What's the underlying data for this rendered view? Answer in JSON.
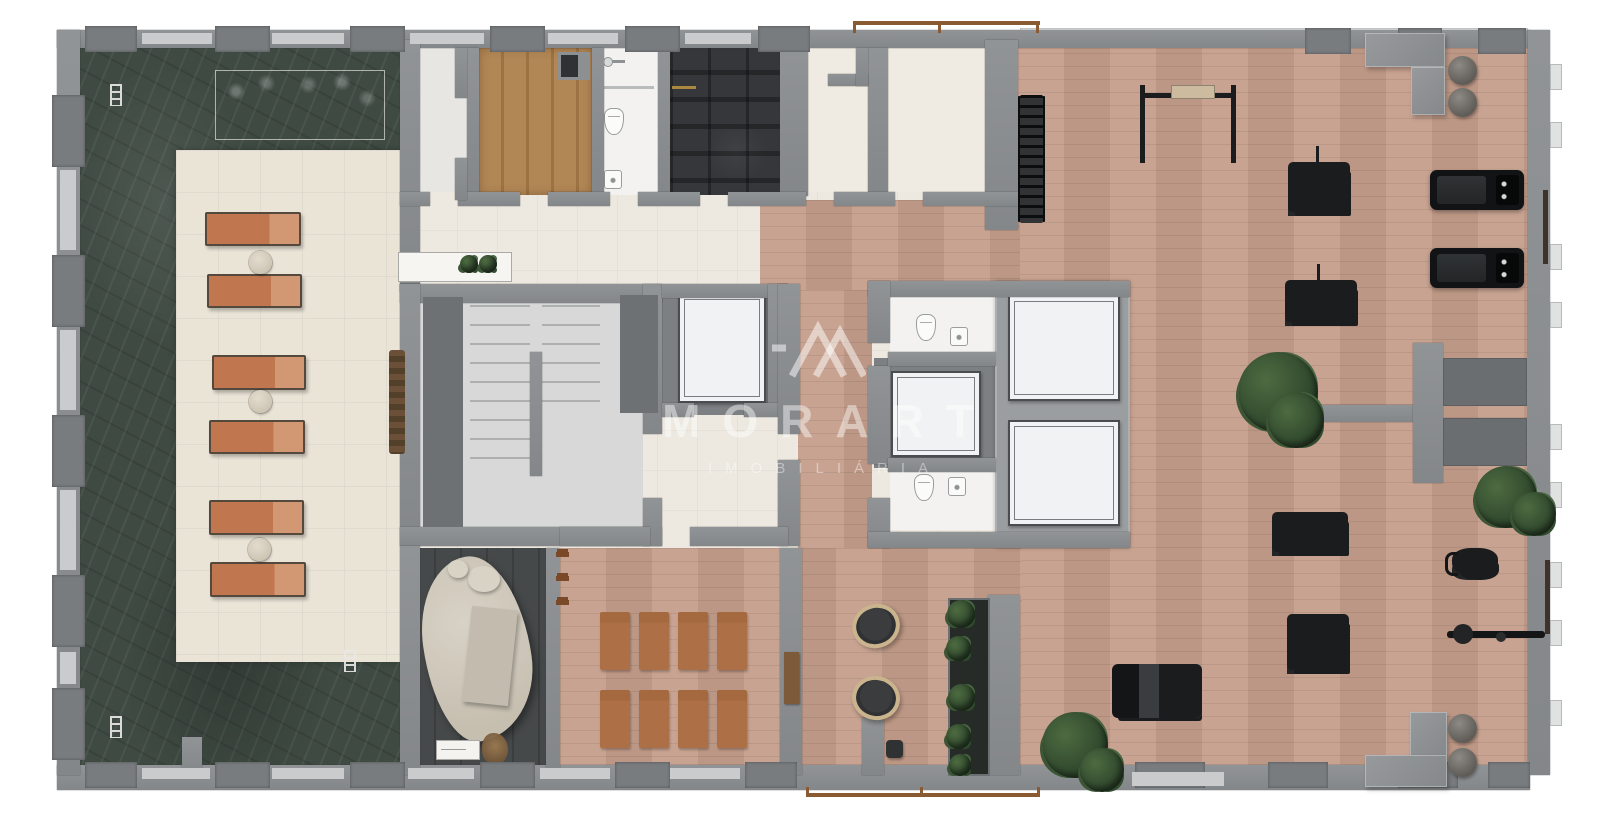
{
  "watermark": {
    "title": "MORART",
    "subtitle": "IMOBILIÁRIA"
  },
  "palette": {
    "pool": "#3e4a42",
    "deck": "#eae4d7",
    "plate": "#ede9e0",
    "wall": "#8a8d8f",
    "wall-dark": "#797c7e",
    "wall-light": "#c9cbcc",
    "wood": "#c59e8b",
    "sauna": "#ad8352",
    "dark-room": "#35373a",
    "slate": "#46494a",
    "slab": "#9b9ea0",
    "lounger": "#c88159",
    "mat": "#ad6f46",
    "equip": "#1b1c1d",
    "rail": "#8a5a33",
    "brass": "#a98940",
    "elev": "#f1f2f3",
    "tile": "#f3f2f0",
    "panel": "#6e7173",
    "green": "#3a5531",
    "cream-tile": "#efebe2",
    "stair-floor": "#d7d8d7"
  },
  "plan": {
    "walls": [
      {
        "name": "wall-top",
        "x": 57,
        "y": 30,
        "w": 1473,
        "h": 18
      },
      {
        "name": "wall-bottom",
        "x": 57,
        "y": 765,
        "w": 1473,
        "h": 25
      },
      {
        "name": "wall-left",
        "x": 57,
        "y": 30,
        "w": 23,
        "h": 745
      },
      {
        "name": "wall-right",
        "x": 1528,
        "y": 30,
        "w": 22,
        "h": 745
      },
      {
        "name": "wall-pool-east",
        "x": 400,
        "y": 40,
        "w": 20,
        "h": 252
      },
      {
        "name": "wall",
        "x": 467,
        "y": 48,
        "w": 12,
        "h": 148
      },
      {
        "name": "wall",
        "x": 592,
        "y": 48,
        "w": 12,
        "h": 148
      },
      {
        "name": "wall",
        "x": 658,
        "y": 48,
        "w": 12,
        "h": 148
      },
      {
        "name": "wall",
        "x": 780,
        "y": 44,
        "w": 28,
        "h": 152
      },
      {
        "name": "wall",
        "x": 868,
        "y": 48,
        "w": 20,
        "h": 148
      },
      {
        "name": "wall-gym-west",
        "x": 985,
        "y": 40,
        "w": 33,
        "h": 190
      },
      {
        "name": "wall",
        "x": 400,
        "y": 192,
        "w": 30,
        "h": 14
      },
      {
        "name": "wall",
        "x": 458,
        "y": 192,
        "w": 62,
        "h": 14
      },
      {
        "name": "wall",
        "x": 548,
        "y": 192,
        "w": 62,
        "h": 14
      },
      {
        "name": "wall",
        "x": 638,
        "y": 192,
        "w": 62,
        "h": 14
      },
      {
        "name": "wall",
        "x": 728,
        "y": 192,
        "w": 78,
        "h": 14
      },
      {
        "name": "wall",
        "x": 834,
        "y": 192,
        "w": 61,
        "h": 14
      },
      {
        "name": "wall",
        "x": 923,
        "y": 192,
        "w": 95,
        "h": 14
      },
      {
        "name": "wall",
        "x": 828,
        "y": 74,
        "w": 40,
        "h": 12
      },
      {
        "name": "wall",
        "x": 856,
        "y": 48,
        "w": 12,
        "h": 38
      },
      {
        "name": "wall",
        "x": 455,
        "y": 48,
        "w": 12,
        "h": 50
      },
      {
        "name": "wall",
        "x": 455,
        "y": 158,
        "w": 12,
        "h": 42
      },
      {
        "name": "stair-wall-n",
        "x": 400,
        "y": 284,
        "w": 262,
        "h": 19
      },
      {
        "name": "stair-wall-w",
        "x": 400,
        "y": 284,
        "w": 20,
        "h": 262
      },
      {
        "name": "stair-wall-s",
        "x": 400,
        "y": 527,
        "w": 262,
        "h": 19
      },
      {
        "name": "stair-wall-e",
        "x": 643,
        "y": 284,
        "w": 19,
        "h": 150
      },
      {
        "name": "wall",
        "x": 643,
        "y": 498,
        "w": 19,
        "h": 48
      },
      {
        "name": "wall",
        "x": 662,
        "y": 284,
        "w": 126,
        "h": 14
      },
      {
        "name": "wall",
        "x": 768,
        "y": 284,
        "w": 20,
        "h": 131
      },
      {
        "name": "wall",
        "x": 662,
        "y": 403,
        "w": 32,
        "h": 14
      },
      {
        "name": "wall",
        "x": 744,
        "y": 403,
        "w": 44,
        "h": 14
      },
      {
        "name": "wall",
        "x": 778,
        "y": 284,
        "w": 22,
        "h": 150
      },
      {
        "name": "wall",
        "x": 778,
        "y": 460,
        "w": 22,
        "h": 86
      },
      {
        "name": "core2-wall-n",
        "x": 868,
        "y": 281,
        "w": 262,
        "h": 16
      },
      {
        "name": "wall",
        "x": 868,
        "y": 281,
        "w": 22,
        "h": 62
      },
      {
        "name": "wall",
        "x": 868,
        "y": 366,
        "w": 22,
        "h": 98
      },
      {
        "name": "wall",
        "x": 868,
        "y": 498,
        "w": 22,
        "h": 50
      },
      {
        "name": "core2-wall-s",
        "x": 868,
        "y": 532,
        "w": 262,
        "h": 16
      },
      {
        "name": "wall",
        "x": 888,
        "y": 352,
        "w": 108,
        "h": 14
      },
      {
        "name": "wall",
        "x": 888,
        "y": 458,
        "w": 108,
        "h": 14
      },
      {
        "name": "wall",
        "x": 400,
        "y": 546,
        "w": 20,
        "h": 229
      },
      {
        "name": "wall",
        "x": 546,
        "y": 548,
        "w": 14,
        "h": 220
      },
      {
        "name": "wall",
        "x": 780,
        "y": 548,
        "w": 22,
        "h": 227
      },
      {
        "name": "wall",
        "x": 988,
        "y": 595,
        "w": 32,
        "h": 180
      },
      {
        "name": "wall",
        "x": 862,
        "y": 718,
        "w": 22,
        "h": 57
      },
      {
        "name": "wall",
        "x": 560,
        "y": 527,
        "w": 90,
        "h": 19
      },
      {
        "name": "wall",
        "x": 690,
        "y": 527,
        "w": 98,
        "h": 19
      },
      {
        "name": "gym-partition-h",
        "x": 1300,
        "y": 405,
        "w": 120,
        "h": 17
      },
      {
        "name": "gym-partition-v",
        "x": 1413,
        "y": 343,
        "w": 30,
        "h": 140
      },
      {
        "name": "pool-pier",
        "x": 182,
        "y": 737,
        "w": 20,
        "h": 36
      }
    ],
    "panels": [
      {
        "name": "stair-dark-panel",
        "x": 423,
        "y": 297,
        "w": 40,
        "h": 230
      },
      {
        "name": "duct-panel",
        "x": 620,
        "y": 295,
        "w": 38,
        "h": 118
      }
    ],
    "piers": [
      {
        "x": 85,
        "y": 26,
        "w": 52,
        "h": 26
      },
      {
        "x": 215,
        "y": 26,
        "w": 55,
        "h": 26
      },
      {
        "x": 350,
        "y": 26,
        "w": 55,
        "h": 26
      },
      {
        "x": 490,
        "y": 26,
        "w": 55,
        "h": 26
      },
      {
        "x": 625,
        "y": 26,
        "w": 55,
        "h": 26
      },
      {
        "x": 758,
        "y": 26,
        "w": 52,
        "h": 26
      },
      {
        "x": 1305,
        "y": 28,
        "w": 46,
        "h": 26
      },
      {
        "x": 1398,
        "y": 28,
        "w": 44,
        "h": 26
      },
      {
        "x": 1478,
        "y": 28,
        "w": 48,
        "h": 26
      },
      {
        "x": 85,
        "y": 762,
        "w": 52,
        "h": 26
      },
      {
        "x": 215,
        "y": 762,
        "w": 55,
        "h": 26
      },
      {
        "x": 350,
        "y": 762,
        "w": 55,
        "h": 26
      },
      {
        "x": 480,
        "y": 762,
        "w": 55,
        "h": 26
      },
      {
        "x": 615,
        "y": 762,
        "w": 55,
        "h": 26
      },
      {
        "x": 745,
        "y": 762,
        "w": 52,
        "h": 26
      },
      {
        "x": 1135,
        "y": 762,
        "w": 70,
        "h": 26
      },
      {
        "x": 1268,
        "y": 762,
        "w": 60,
        "h": 26
      },
      {
        "x": 1398,
        "y": 762,
        "w": 60,
        "h": 26
      },
      {
        "x": 1488,
        "y": 762,
        "w": 42,
        "h": 26
      },
      {
        "x": 52,
        "y": 95,
        "w": 33,
        "h": 72
      },
      {
        "x": 52,
        "y": 255,
        "w": 33,
        "h": 72
      },
      {
        "x": 52,
        "y": 415,
        "w": 33,
        "h": 72
      },
      {
        "x": 52,
        "y": 575,
        "w": 33,
        "h": 72
      },
      {
        "x": 52,
        "y": 688,
        "w": 33,
        "h": 72
      }
    ],
    "infills": [
      {
        "x": 142,
        "y": 33,
        "w": 70,
        "h": 11
      },
      {
        "x": 272,
        "y": 33,
        "w": 72,
        "h": 11
      },
      {
        "x": 410,
        "y": 33,
        "w": 74,
        "h": 11
      },
      {
        "x": 548,
        "y": 33,
        "w": 70,
        "h": 11
      },
      {
        "x": 685,
        "y": 33,
        "w": 66,
        "h": 11
      },
      {
        "x": 142,
        "y": 768,
        "w": 68,
        "h": 11
      },
      {
        "x": 272,
        "y": 768,
        "w": 72,
        "h": 11
      },
      {
        "x": 408,
        "y": 768,
        "w": 66,
        "h": 11
      },
      {
        "x": 540,
        "y": 768,
        "w": 70,
        "h": 11
      },
      {
        "x": 670,
        "y": 768,
        "w": 70,
        "h": 11
      },
      {
        "x": 1132,
        "y": 772,
        "w": 92,
        "h": 14
      },
      {
        "x": 60,
        "y": 170,
        "w": 16,
        "h": 80
      },
      {
        "x": 60,
        "y": 330,
        "w": 16,
        "h": 80
      },
      {
        "x": 60,
        "y": 490,
        "w": 16,
        "h": 80
      },
      {
        "x": 60,
        "y": 652,
        "w": 16,
        "h": 32
      }
    ],
    "nubs": [
      {
        "x": 1550,
        "y": 64,
        "w": 12,
        "h": 26
      },
      {
        "x": 1550,
        "y": 122,
        "w": 12,
        "h": 26
      },
      {
        "x": 1550,
        "y": 244,
        "w": 12,
        "h": 26
      },
      {
        "x": 1550,
        "y": 302,
        "w": 12,
        "h": 26
      },
      {
        "x": 1550,
        "y": 424,
        "w": 12,
        "h": 26
      },
      {
        "x": 1550,
        "y": 482,
        "w": 12,
        "h": 26
      },
      {
        "x": 1550,
        "y": 562,
        "w": 12,
        "h": 26
      },
      {
        "x": 1550,
        "y": 620,
        "w": 12,
        "h": 26
      },
      {
        "x": 1550,
        "y": 700,
        "w": 12,
        "h": 26
      }
    ],
    "loungers": [
      {
        "x": 205,
        "y": 212,
        "w": 96,
        "h": 34
      },
      {
        "x": 207,
        "y": 274,
        "w": 95,
        "h": 34
      },
      {
        "x": 212,
        "y": 355,
        "w": 94,
        "h": 35
      },
      {
        "x": 209,
        "y": 420,
        "w": 96,
        "h": 34
      },
      {
        "x": 209,
        "y": 500,
        "w": 95,
        "h": 35
      },
      {
        "x": 210,
        "y": 562,
        "w": 96,
        "h": 35
      }
    ],
    "side_tables": [
      {
        "x": 249,
        "y": 251,
        "w": 23,
        "h": 23
      },
      {
        "x": 249,
        "y": 390,
        "w": 23,
        "h": 23
      },
      {
        "x": 248,
        "y": 538,
        "w": 23,
        "h": 23
      }
    ],
    "ladders": [
      {
        "x": 110,
        "y": 84,
        "w": 12,
        "h": 22
      },
      {
        "x": 110,
        "y": 716,
        "w": 12,
        "h": 22
      },
      {
        "x": 344,
        "y": 650,
        "w": 12,
        "h": 22
      }
    ],
    "yoga_mats": [
      {
        "x": 600,
        "y": 612,
        "w": 30,
        "h": 58
      },
      {
        "x": 639,
        "y": 612,
        "w": 30,
        "h": 58
      },
      {
        "x": 678,
        "y": 612,
        "w": 30,
        "h": 58
      },
      {
        "x": 717,
        "y": 612,
        "w": 30,
        "h": 58
      },
      {
        "x": 600,
        "y": 690,
        "w": 30,
        "h": 58
      },
      {
        "x": 639,
        "y": 690,
        "w": 30,
        "h": 58
      },
      {
        "x": 678,
        "y": 690,
        "w": 30,
        "h": 58
      },
      {
        "x": 717,
        "y": 690,
        "w": 30,
        "h": 58
      }
    ],
    "hooks": [
      {
        "x": 556,
        "y": 552,
        "w": 13,
        "h": 5
      },
      {
        "x": 556,
        "y": 576,
        "w": 13,
        "h": 5
      },
      {
        "x": 556,
        "y": 600,
        "w": 13,
        "h": 5
      }
    ],
    "plants": [
      {
        "name": "plant",
        "x": 1238,
        "y": 352,
        "w": 80,
        "h": 80
      },
      {
        "name": "plant",
        "x": 1268,
        "y": 392,
        "w": 56,
        "h": 56
      },
      {
        "name": "plant",
        "x": 1475,
        "y": 466,
        "w": 62,
        "h": 62
      },
      {
        "name": "plant",
        "x": 1512,
        "y": 492,
        "w": 44,
        "h": 44
      },
      {
        "name": "plant",
        "x": 1042,
        "y": 712,
        "w": 66,
        "h": 66
      },
      {
        "name": "plant",
        "x": 1080,
        "y": 748,
        "w": 44,
        "h": 44
      },
      {
        "name": "console-plant",
        "x": 460,
        "y": 255,
        "w": 18,
        "h": 18
      },
      {
        "name": "console-plant",
        "x": 479,
        "y": 255,
        "w": 18,
        "h": 18
      },
      {
        "name": "greenwall-plant",
        "x": 947,
        "y": 600,
        "w": 28,
        "h": 28
      },
      {
        "name": "greenwall-plant",
        "x": 946,
        "y": 636,
        "w": 25,
        "h": 25
      },
      {
        "name": "greenwall-plant",
        "x": 948,
        "y": 684,
        "w": 27,
        "h": 27
      },
      {
        "name": "greenwall-plant",
        "x": 946,
        "y": 724,
        "w": 25,
        "h": 25
      },
      {
        "name": "greenwall-plant",
        "x": 949,
        "y": 754,
        "w": 22,
        "h": 22
      }
    ],
    "machines": [
      {
        "name": "dumbbell-rack",
        "x": 1020,
        "y": 95,
        "w": 23,
        "h": 128,
        "variant": "v-rack"
      },
      {
        "name": "squat-rack",
        "x": 1140,
        "y": 85,
        "w": 96,
        "h": 78,
        "variant": "v-squat"
      },
      {
        "name": "seated-machine",
        "x": 1288,
        "y": 162,
        "w": 62,
        "h": 50,
        "variant": "v-pole"
      },
      {
        "name": "cable-machine",
        "x": 1285,
        "y": 280,
        "w": 72,
        "h": 42,
        "variant": "v-pole"
      },
      {
        "name": "bench-machine",
        "x": 1272,
        "y": 512,
        "w": 76,
        "h": 40,
        "variant": ""
      },
      {
        "name": "multi-gym",
        "x": 1287,
        "y": 614,
        "w": 62,
        "h": 56,
        "variant": ""
      },
      {
        "name": "leg-press",
        "x": 1112,
        "y": 664,
        "w": 90,
        "h": 54,
        "variant": "v-press"
      },
      {
        "name": "rowing-machine",
        "x": 1447,
        "y": 622,
        "w": 98,
        "h": 26,
        "variant": "v-row"
      },
      {
        "name": "spin-bike",
        "x": 1452,
        "y": 548,
        "w": 46,
        "h": 28,
        "variant": "v-bike"
      }
    ],
    "treadmills": [
      {
        "x": 1430,
        "y": 170,
        "w": 94,
        "h": 40
      },
      {
        "x": 1430,
        "y": 248,
        "w": 94,
        "h": 40
      }
    ],
    "balls": [
      {
        "x": 1448,
        "y": 56,
        "w": 29,
        "h": 29
      },
      {
        "x": 1448,
        "y": 88,
        "w": 29,
        "h": 29
      },
      {
        "x": 1448,
        "y": 714,
        "w": 29,
        "h": 29
      },
      {
        "x": 1448,
        "y": 748,
        "w": 29,
        "h": 29
      }
    ],
    "gblocks": [
      {
        "name": "bench-top-h",
        "x": 1365,
        "y": 33,
        "w": 80,
        "h": 34
      },
      {
        "name": "bench-top-v",
        "x": 1411,
        "y": 67,
        "w": 34,
        "h": 48
      },
      {
        "name": "bench-bottom-v",
        "x": 1410,
        "y": 712,
        "w": 37,
        "h": 46
      },
      {
        "name": "bench-bottom-h",
        "x": 1365,
        "y": 755,
        "w": 82,
        "h": 32
      }
    ],
    "dmats": [
      {
        "x": 1443,
        "y": 358,
        "w": 84,
        "h": 48
      },
      {
        "x": 1443,
        "y": 418,
        "w": 84,
        "h": 48
      }
    ],
    "bars": [
      {
        "name": "wall-bar",
        "x": 1543,
        "y": 190,
        "w": 5,
        "h": 74
      },
      {
        "name": "wall-bar",
        "x": 1545,
        "y": 560,
        "w": 5,
        "h": 74
      }
    ]
  }
}
